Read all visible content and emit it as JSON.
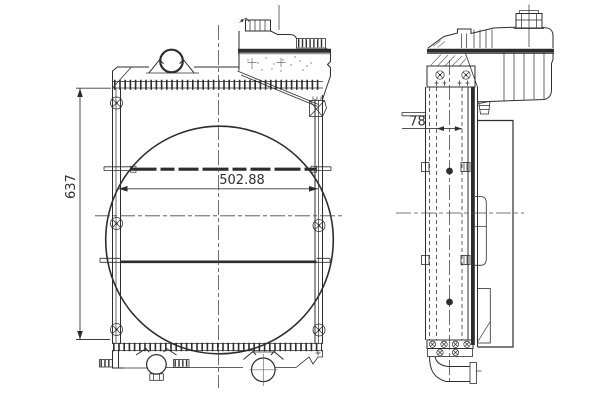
{
  "page": {
    "background": "#ffffff"
  },
  "drawing": {
    "kind": "radiator-orthographic-technical-drawing",
    "line_color": "#2d2d2d",
    "centerline_color": "#4a4a4a",
    "dimension_text_color": "#2f2f2f"
  },
  "dimensions": {
    "overall_height": "637",
    "core_width": "502.88",
    "core_depth": "78"
  }
}
